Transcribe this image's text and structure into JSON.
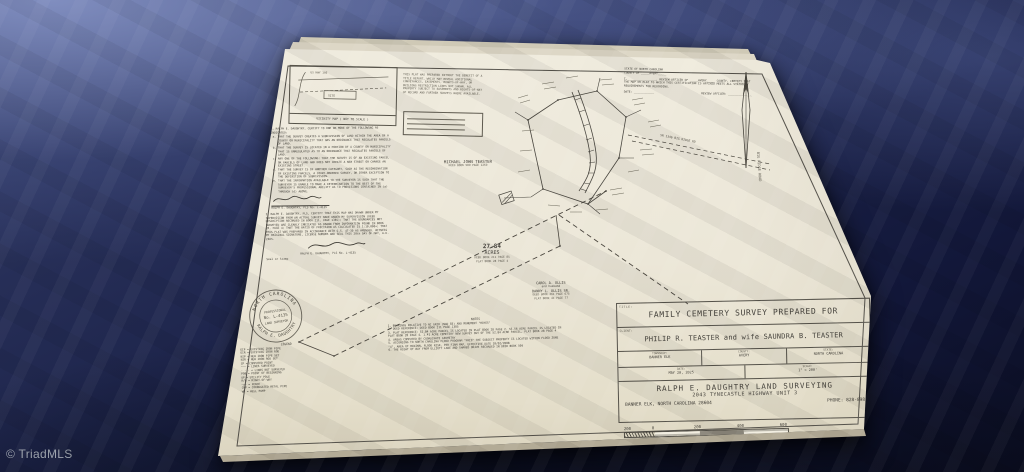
{
  "watermark": "© TriadMLS",
  "paper": {
    "vicinity": {
      "title": "VICINITY MAP ( NOT TO SCALE )",
      "highway": "US HWY 19E",
      "site": "SITE"
    },
    "disclaimer": "THIS PLAT WAS PREPARED WITHOUT THE BENEFIT OF A TITLE REPORT, WHICH MAY REVEAL ADDITIONAL CONVEYANCES, EASEMENTS, RIGHTS-OF-WAY, OR BUILDING RESTRICTION LINES NOT SHOWN. ALL PROPERTY SUBJECT TO EASEMENTS AND RIGHTS-OF-WAY OF RECORD AND FURTHER SURVEYS WHERE AVAILABLE.",
    "review": {
      "state": "STATE OF NORTH CAROLINA",
      "county": "COUNTY OF _____AVERY_____",
      "body": "I, ________________, REVIEW OFFICER OF _____AVERY_____ COUNTY, CERTIFY THAT THE MAP OR PLAT TO WHICH THIS CERTIFICATION IS AFFIXED MEETS ALL STATUTORY REQUIREMENTS FOR RECORDING.",
      "date_line": "DATE: ____________",
      "officer_line": "REVIEW OFFICER: ______________"
    },
    "certification_list": {
      "intro": "I, RALPH E. DAUGHTRY, CERTIFY TO ONE OR MORE OF THE FOLLOWING AS INDICATED:",
      "items": [
        "THAT THE SURVEY CREATES A SUBDIVISION OF LAND WITHIN THE AREA OF A COUNTY OR MUNICIPALITY THAT HAS AN ORDINANCE THAT REGULATES PARCELS OF LAND.",
        "THAT THE SURVEY IS LOCATED IN A PORTION OF A COUNTY OR MUNICIPALITY THAT IS UNREGULATED AS TO AN ORDINANCE THAT REGULATES PARCELS OF LAND.",
        "ANY ONE OF THE FOLLOWING: THAT THE SURVEY IS OF AN EXISTING PARCEL OR PARCELS OF LAND AND DOES NOT CREATE A NEW STREET OR CHANGE AN EXISTING STREET.",
        "THAT THE SURVEY IS OF ANOTHER CATEGORY, SUCH AS THE RECOMBINATION OF EXISTING PARCELS, A COURT-ORDERED SURVEY, OR OTHER EXCEPTION TO THE DEFINITION OF SUBDIVISION.",
        "THAT THE INFORMATION AVAILABLE TO THE SURVEYOR IS SUCH THAT THE SURVEYOR IS UNABLE TO MAKE A DETERMINATION TO THE BEST OF THE SURVEYOR'S PROFESSIONAL ABILITY AS TO PROVISIONS CONTAINED IN (a) THROUGH (d) ABOVE."
      ],
      "signature": "RALPH E. DAUGHTRY, PLS No. L-4135"
    },
    "certification_paragraph": {
      "body": "I, RALPH E. DAUGHTRY, PLS, CERTIFY THAT THIS MAP WAS DRAWN UNDER MY SUPERVISION FROM AN ACTUAL SURVEY MADE UNDER MY SUPERVISION (DEED DESCRIPTION RECORDED IN BOOK 211, PAGE 1385); THAT THE BOUNDARIES NOT SURVEYED ARE CLEARLY INDICATED AS DRAWN FROM INFORMATION FOUND IN BOOK 28, PAGE 4; THAT THE RATIO OF PRECISION AS CALCULATED IS 1:10,000+; THAT THIS PLAT WAS PREPARED IN ACCORDANCE WITH G.S. 47-30 AS AMENDED. WITNESS MY ORIGINAL SIGNATURE, LICENSE NUMBER AND SEAL THIS 20th DAY OF MAY, A.D. 2025.",
      "signature": "RALPH E. DAUGHTRY, PLS No. L-4135",
      "seal_label": "Seal or Stamp"
    },
    "seal": {
      "ring_top": "NORTH CAROLINA",
      "ring_bottom": "RALPH E. DAUGHTRY",
      "line1": "PROFESSIONAL",
      "number": "No. L-4135",
      "line2": "LAND SURVEYOR"
    },
    "legend": {
      "title": "LEGEND",
      "items": [
        "EIP = EXISTING IRON PIPE",
        "EIR = EXISTING IRON ROD",
        "NIP = NEW IRON PIPE SET",
        "NIR = NEW IRON ROD SET",
        "CP  = COMPUTED POINT",
        "——— = LINES SURVEYED",
        "- - - = LINES NOT SURVEYED",
        "POB = POINT OF BEGINNING",
        "UP  = UTILITY POLE",
        "R/W = RIGHT-OF-WAY",
        "—x— = FENCE",
        "CMP = CORRUGATED METAL PIPE",
        "WP  = WELL PUMP"
      ]
    },
    "parcel": {
      "owner_north": "MICHAEL JOHN TEASTER",
      "owner_north_ref": "DEED BOOK 509 PAGE 1269",
      "acres_value": "27.84",
      "acres_unit": "ACRES",
      "acres_deed": "DEED BOOK 211 PAGE 85",
      "acres_plat": "PLAT BOOK 28 PAGE 4",
      "owner_south_1": "CAROL A. OLLIS",
      "owner_south_2": "and husband",
      "owner_south_3": "DANNY L. OLLIS SR.",
      "owner_south_deed": "DEED BOOK 361 PAGE 675",
      "owner_south_plat": "PLAT BOOK 41 PAGE 77",
      "road_label_1": "SR 1346 BIG RIDGE RD",
      "road_label_2": "BIG RIDGE ROAD"
    },
    "notes": {
      "title": "NOTES",
      "items": [
        "1. BEARINGS RELATIVE TO NC GRID (NAD 83) AND MONUMENT \"HAYES\"",
        "2. DEED REFERENCE: DEED BOOK 211 PAGE 1385",
        "3. PLAT REFERENCE: 52.84 ACRE PARCEL IS LOCATED IN PLAT BOOK 28 PAGE 2. 55.56 ACRE PARCEL IS LOCATED IN PLAT BOOK 28 PAGE 4. 1.41 ACRE CEMETERY NEW SURVEY OUT OF THE 52.84 ACRE PARCEL, PLAT BOOK 28 PAGE 4",
        "4. AREAS COMPUTED BY COORDINATE GEOMETRY",
        "5. ACCORDING TO NORTH CAROLINA FLOOD PROGRAM \"FRIS\" THE SUBJECT PROPERTY IS LOCATED WITHIN FLOOD ZONE \"X\", AREA OF MINIMAL FLOOD RISK, PER FIRM MAP, EFFECTIVE DATE 10/02/2008",
        "6. THE RIGHT OF WAY FROM ELLIOTT LANE AND SHARED DRIVE RECORDED IN DEED BOOK 509"
      ]
    },
    "title_block": {
      "title_tag": "TITLE:",
      "title": "FAMILY CEMETERY SURVEY PREPARED FOR",
      "client_tag": "CLIENT:",
      "client": "PHILIP R. TEASTER and wife SAUNDRA B. TEASTER",
      "township_label": "TOWNSHIP:",
      "township": "BANNER ELK",
      "county_label": "COUNTY:",
      "county": "AVERY",
      "state_label": "STATE:",
      "state": "NORTH CAROLINA",
      "date_label": "DATE:",
      "date": "MAY 20, 2025",
      "scale_label": "SCALE:",
      "scale": "1\" = 200'",
      "firm": "RALPH E. DAUGHTRY LAND SURVEYING",
      "address": "2043 TYNECASTLE HIGHWAY UNIT 3",
      "city": "BANNER ELK, NORTH CAROLINA 28604",
      "phone": "PHONE: 828-898"
    },
    "scale_bar": {
      "ticks": [
        "200",
        "0",
        "200",
        "400",
        "600"
      ],
      "caption": "GRAPHIC SCALE - FEET",
      "map_number": "MAP # 527"
    }
  }
}
